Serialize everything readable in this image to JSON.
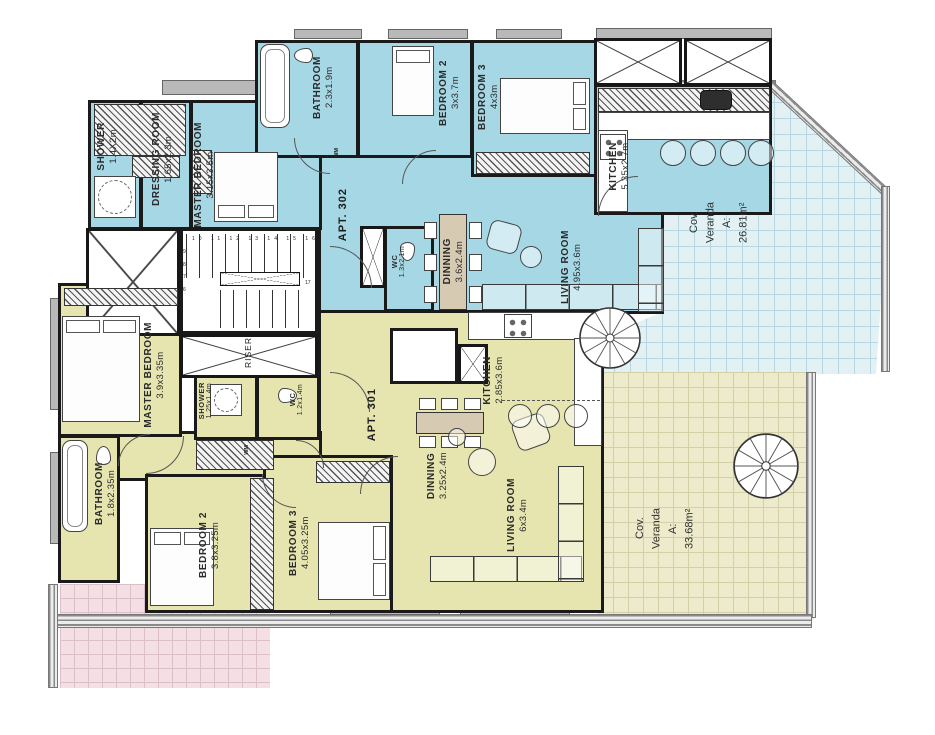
{
  "apartments": {
    "apt302": {
      "label": "APT. 302",
      "fill": "#a6d7e4",
      "rooms": {
        "shower": {
          "name": "SHOWER",
          "dims": "1.4X2m"
        },
        "dressing": {
          "name": "DRESSING ROOM",
          "dims": "1.65x2.3m"
        },
        "master": {
          "name": "MASTER BEDROOM",
          "dims": "3.15x3.5m"
        },
        "bathroom": {
          "name": "BATHROOM",
          "dims": "2.3x1.9m"
        },
        "bedroom2": {
          "name": "BEDROOM 2",
          "dims": "3x3.7m"
        },
        "bedroom3": {
          "name": "BEDROOM 3",
          "dims": "4x3m"
        },
        "kitchen": {
          "name": "KITCHEN",
          "dims": "5.35x2.7m"
        },
        "wc": {
          "name": "WC",
          "dims": "1.3x2.1m"
        },
        "dinning": {
          "name": "DINNING",
          "dims": "3.6x2.4m"
        },
        "living": {
          "name": "LIVING ROOM",
          "dims": "4.95x3.6m"
        }
      },
      "veranda": {
        "line1": "Cov.",
        "line2": "Veranda",
        "line3": "A:",
        "line4": "26.81m²"
      }
    },
    "apt301": {
      "label": "APT. 301",
      "fill": "#e6e5b0",
      "rooms": {
        "master": {
          "name": "MASTER BEDROOM",
          "dims": "3.9x3.35m"
        },
        "shower": {
          "name": "SHOWER",
          "dims": "1.25x1.4m"
        },
        "wc": {
          "name": "WC",
          "dims": "1.2x1.4m"
        },
        "bathroom": {
          "name": "BATHROOM",
          "dims": "1.8x2.35m"
        },
        "bedroom2": {
          "name": "BEDROOM 2",
          "dims": "3.8x3.25m"
        },
        "bedroom3": {
          "name": "BEDROOM 3",
          "dims": "4.05x3.25m"
        },
        "kitchen": {
          "name": "KITCHEN",
          "dims": "2.85x3.6m"
        },
        "dinning": {
          "name": "DINNING",
          "dims": "3.25x2.4m"
        },
        "living": {
          "name": "LIVING ROOM",
          "dims": "6x3.4m"
        }
      },
      "veranda": {
        "line1": "Cov.",
        "line2": "Veranda",
        "line3": "A:",
        "line4": "33.68m²"
      }
    }
  },
  "core": {
    "riser": "RISER",
    "wm": "WM",
    "stairs_top": "10 11 12 13 14 15 16",
    "stairs_left": "9\n8\n7\n6",
    "stairs_right": "17"
  },
  "colors": {
    "apt302_fill": "#a6d7e4",
    "apt301_fill": "#e6e5b0",
    "veranda302_tile": "#e3f1f5",
    "veranda301_tile": "#edebcb",
    "veranda_pink_tile": "#f3dfe4",
    "wall": "#1a1a1a"
  }
}
